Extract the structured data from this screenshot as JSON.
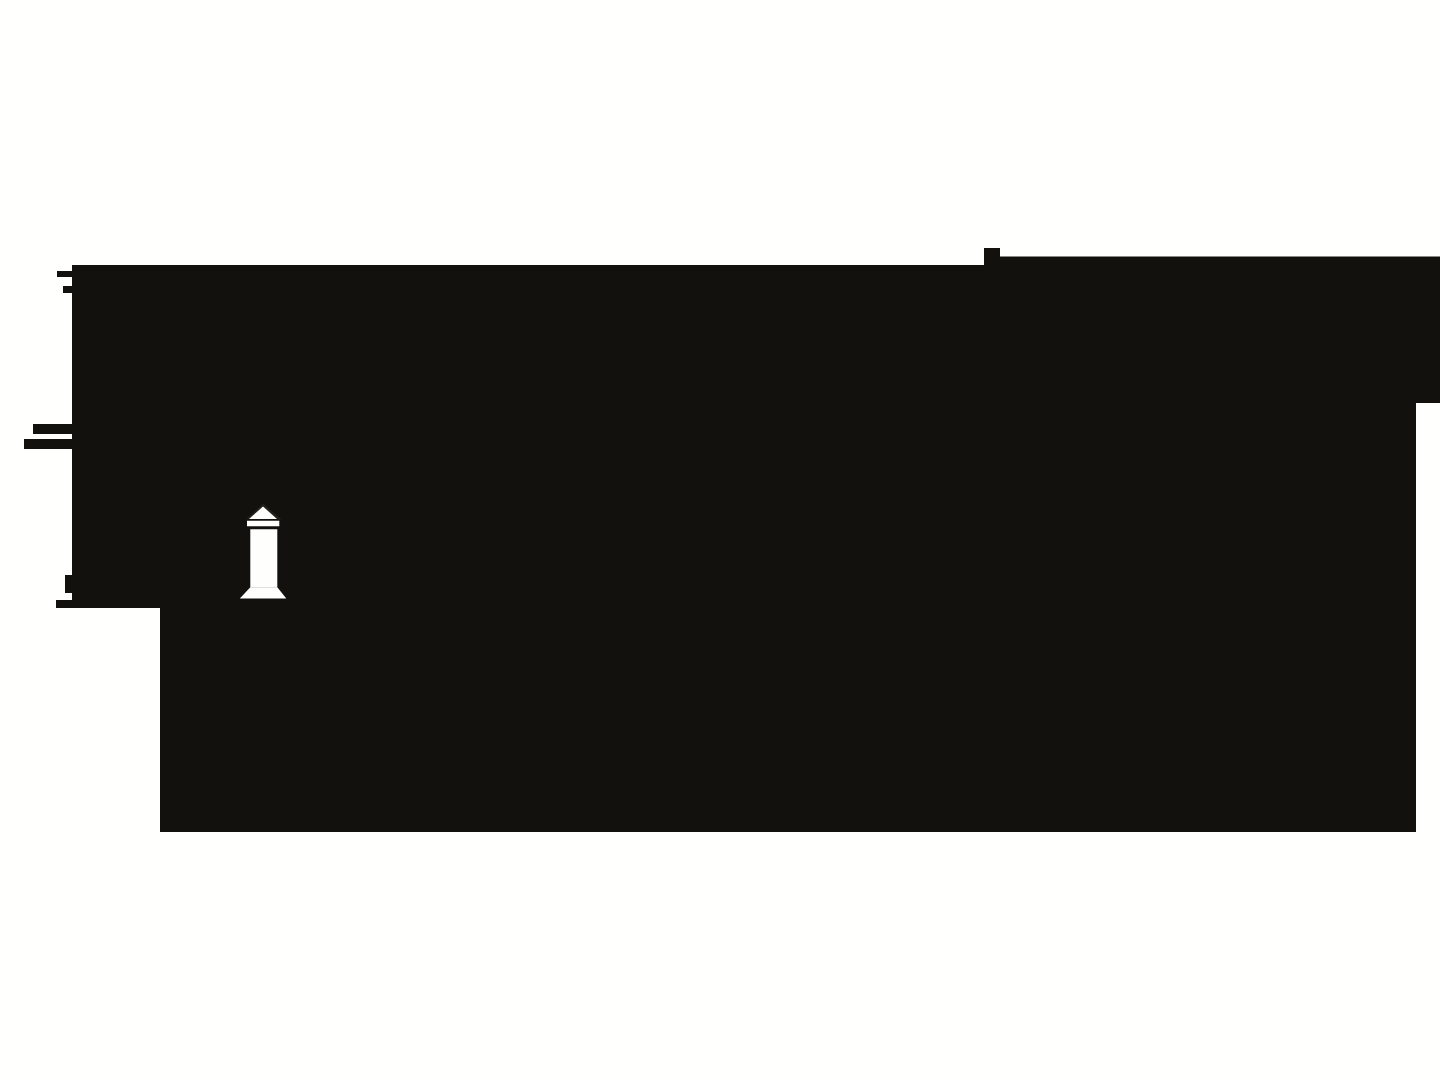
{
  "canvas": {
    "width": 1440,
    "height": 1080,
    "background_color": "#fffffe"
  },
  "graphic": {
    "description": "large black silhouette block with stepped jagged edges and a white obelisk monument glyph cut out of it",
    "colors": {
      "silhouette": "#12110d",
      "obelisk_white": "#fefefc",
      "pyramidion_shadow": "#21211b"
    },
    "shapes": [
      {
        "name": "silhouette-mass",
        "fill": "#12110d",
        "points": "72,265 984,265 984,248 1000,248 1000,256.5 1440,256.5 1440,403 1416,403 1416,832 160,832 160,608 56,608 56,600 72,600 72,593 65,593 65,575 72,575 72,449 24,449 24,439 72,439 72,434 33,434 33,424 72,424 72,293 63,293 63,286 72,286 72,277 57,277 57,271 72,271"
      },
      {
        "name": "pyramidion-shadow-icon",
        "fill": "#21211b",
        "points": "246.5,519 263,503.5 281.5,519.5 277.5,519.5 263,507.5 250.5,519"
      },
      {
        "name": "obelisk-pyramidion-icon",
        "fill": "#fefefc",
        "points": "263,506.5 277,519 249,519"
      },
      {
        "name": "obelisk-band-icon",
        "fill": "#fefefc",
        "points": "247,520.7 279.3,520.7 279.3,526.3 247,526.3"
      },
      {
        "name": "obelisk-shaft-icon",
        "fill": "#fefefc",
        "points": "250.3,529.3 277.3,529.3 277.3,587.3 250.3,587.3"
      },
      {
        "name": "obelisk-base-icon",
        "fill": "#fefefc",
        "points": "250.3,587.3 277.3,587.3 286.3,598.5 239.8,598.5"
      }
    ]
  }
}
